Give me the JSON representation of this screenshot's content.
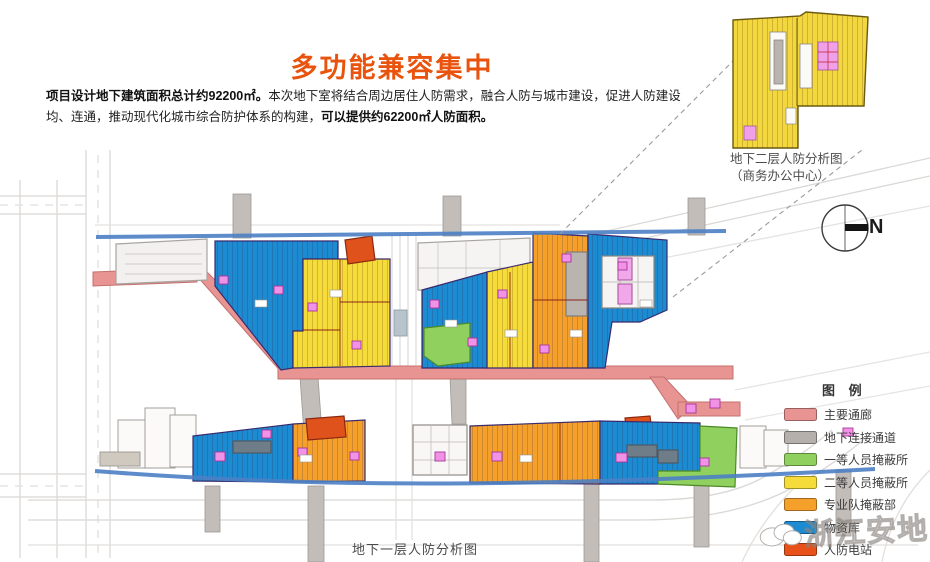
{
  "title": "多功能兼容集中",
  "intro": {
    "line1_bold": "项目设计地下建筑面积总计约92200㎡。",
    "line1_regular": "本次地下室将结合周边居住人防需求，融合人防与城市建设，促进人防建设",
    "line2_regular": "均、连通，推动现代化城市综合防护体系的构建，",
    "line2_bold": "可以提供约62200㎡人防面积。"
  },
  "inset": {
    "caption_line1": "地下二层人防分析图",
    "caption_line2": "（商务办公中心）"
  },
  "compass": {
    "label": "N"
  },
  "legend": {
    "title": "图 例",
    "items": [
      {
        "label": "主要通廊",
        "color": "#e89492"
      },
      {
        "label": "地下连接通道",
        "color": "#b5b0ab"
      },
      {
        "label": "一等人员掩蔽所",
        "color": "#8fd05f"
      },
      {
        "label": "二等人员掩蔽所",
        "color": "#f6dc3b"
      },
      {
        "label": "专业队掩蔽部",
        "color": "#f5a02b"
      },
      {
        "label": "物资库",
        "color": "#1d8bd1"
      },
      {
        "label": "人防电站",
        "color": "#e8511a"
      },
      {
        "label": "人防出入口",
        "color": "#f092e6"
      }
    ]
  },
  "map_caption": "地下一层人防分析图",
  "watermark": {
    "text": "浙江安地"
  },
  "colors": {
    "title_accent": "#e8530e",
    "main_corridor": "#e89492",
    "underground_passage": "#b9b4af",
    "shelter_grade1_green": "#8fd05f",
    "shelter_grade2_yellow": "#f6dc3b",
    "professional_team_orange": "#f5a02b",
    "materials_depot_blue": "#1d8bd1",
    "power_station_red": "#e0521c",
    "entrance_magenta": "#f092e6",
    "road_blue_line": "#4d7fc4"
  }
}
